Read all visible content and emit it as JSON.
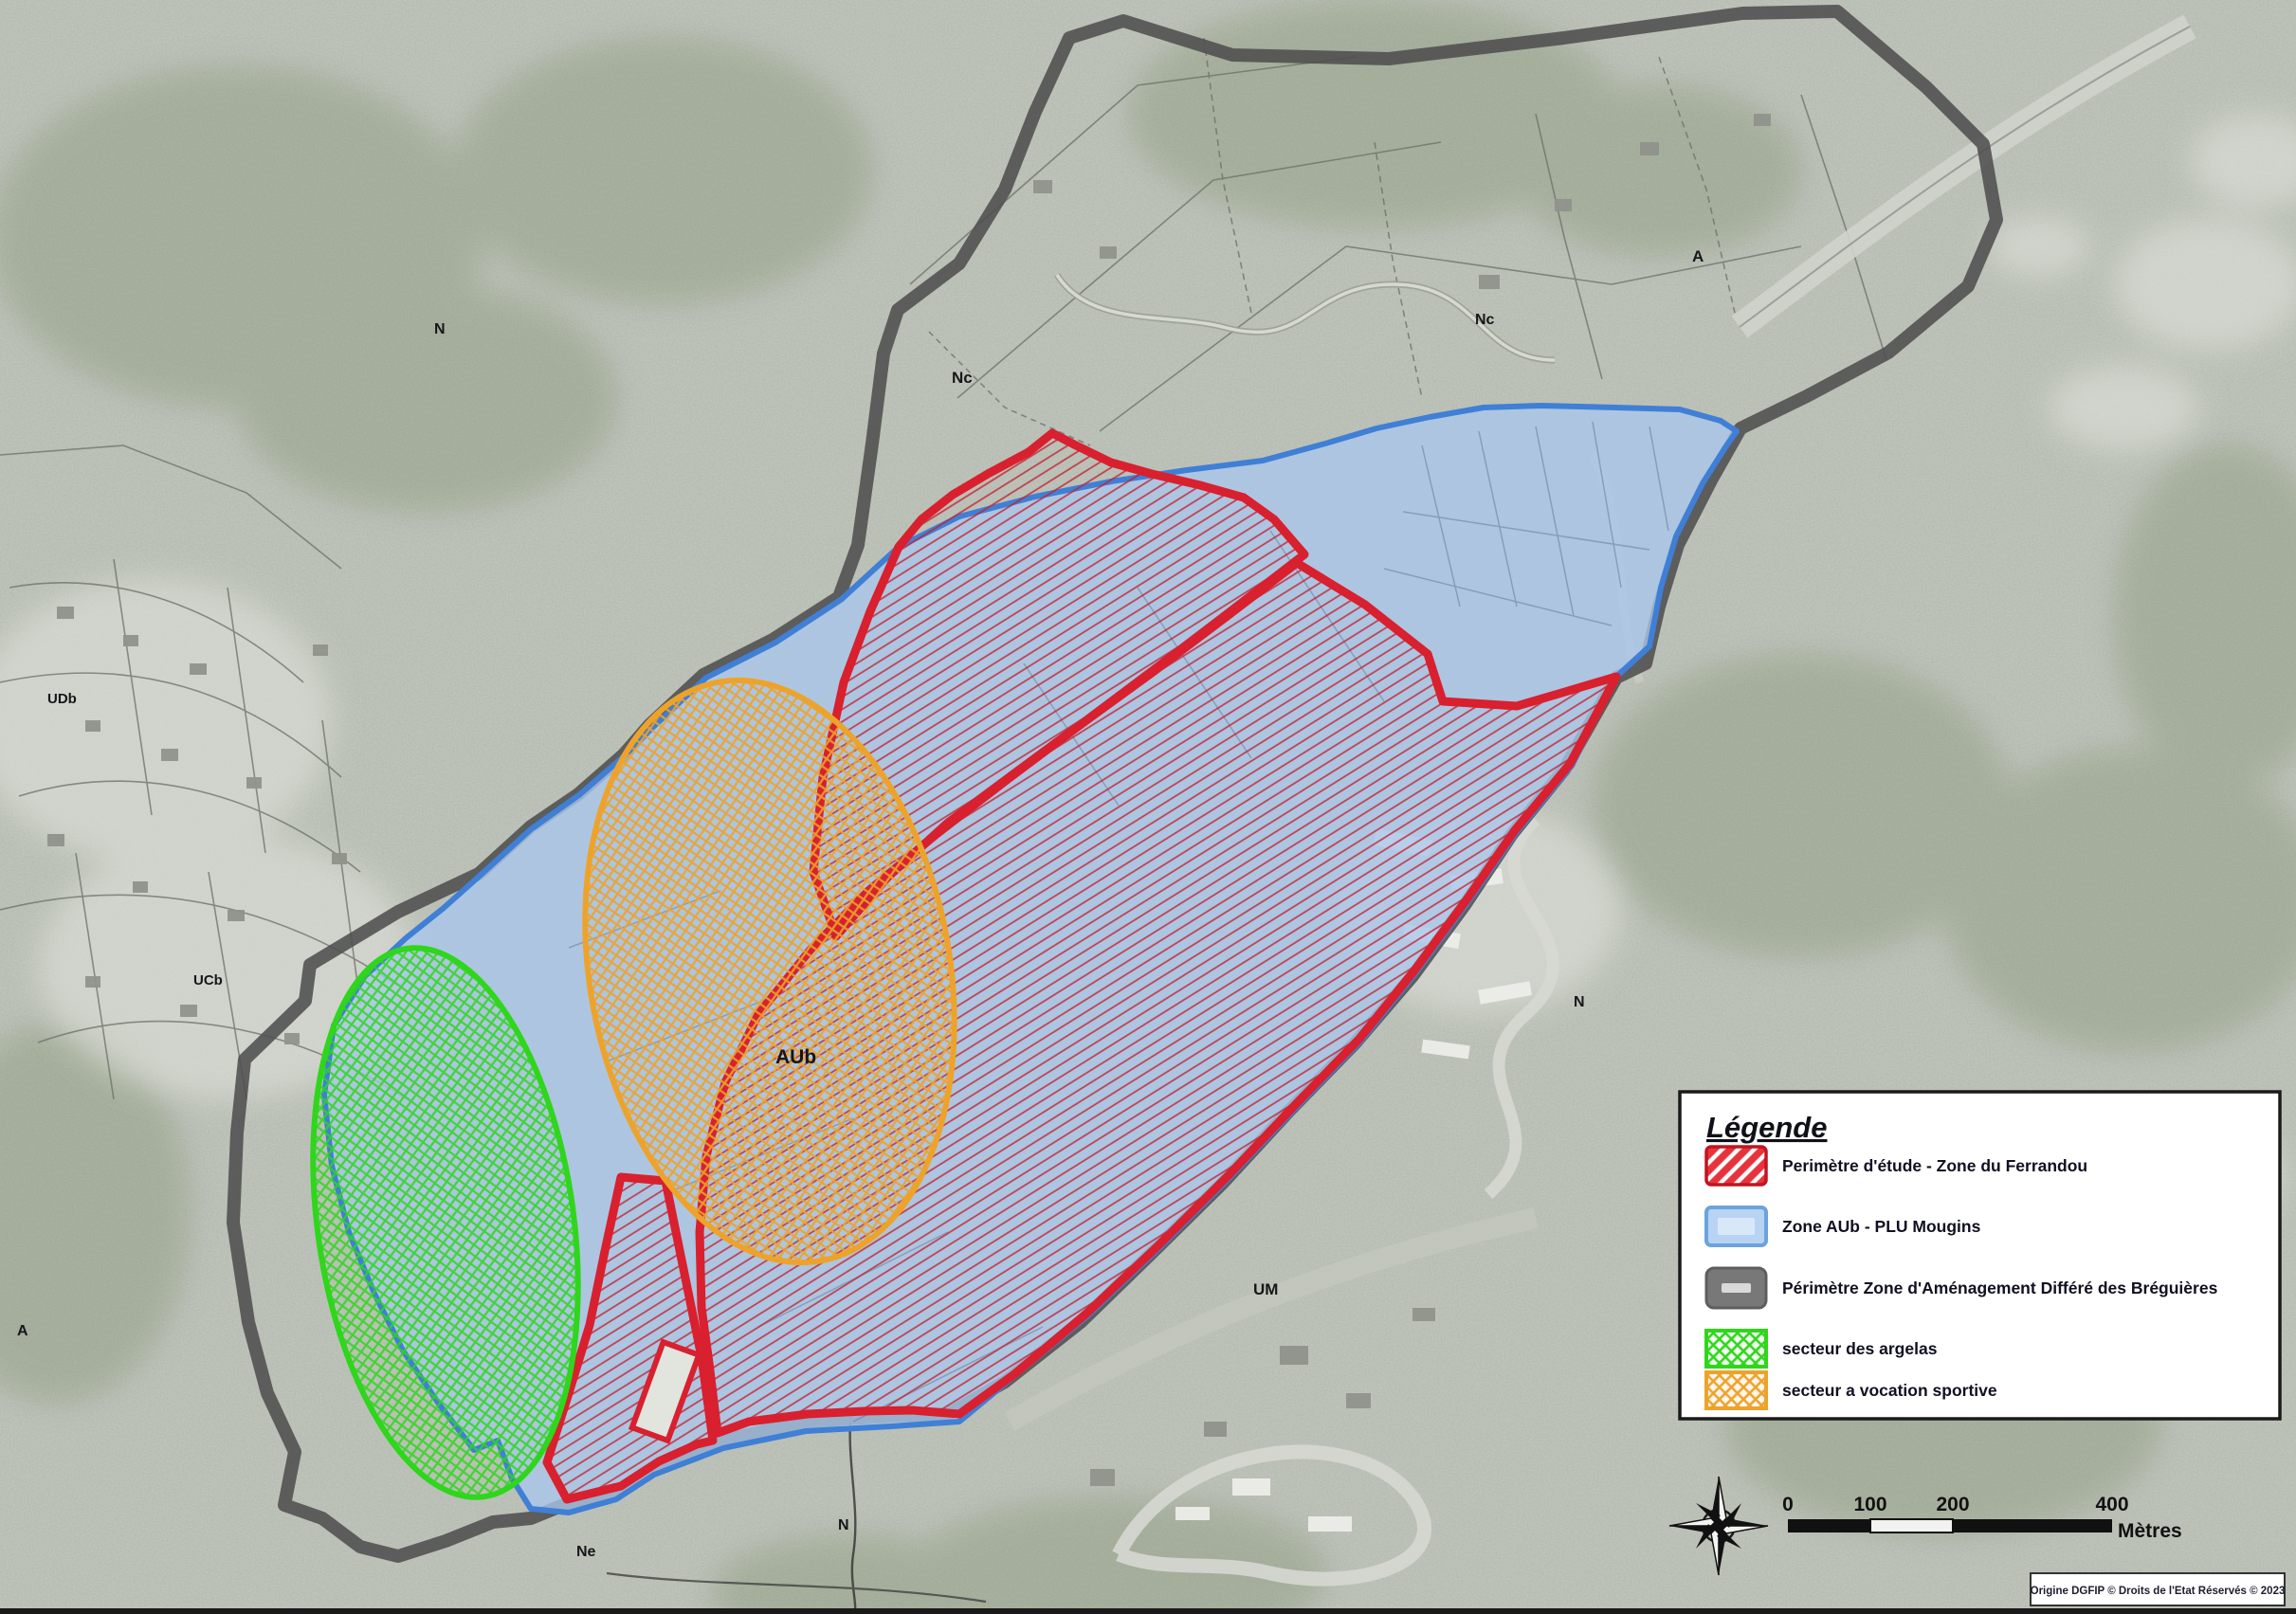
{
  "legend": {
    "title": "Légende",
    "items": [
      {
        "id": "perimetre-etude",
        "label": "Perimètre d'étude - Zone du Ferrandou",
        "swatch": "red-hatch",
        "color": "#d8202f"
      },
      {
        "id": "zone-aub",
        "label": "Zone AUb - PLU Mougins",
        "swatch": "blue-fill",
        "color": "#6ba3de"
      },
      {
        "id": "zad-breguieres",
        "label": "Périmètre Zone d'Aménagement Différé des Bréguières",
        "swatch": "gray-outline",
        "color": "#787878"
      },
      {
        "id": "secteur-argelas",
        "label": "secteur des argelas",
        "swatch": "green-crosshatch",
        "color": "#2fd61c"
      },
      {
        "id": "secteur-sportif",
        "label": "secteur a vocation sportive",
        "swatch": "orange-crosshatch",
        "color": "#eda32b"
      }
    ]
  },
  "map_labels": [
    {
      "id": "zone-n-northwest",
      "text": "N"
    },
    {
      "id": "zone-nc-center",
      "text": "Nc"
    },
    {
      "id": "zone-nc-east",
      "text": "Nc"
    },
    {
      "id": "zone-a-northeast",
      "text": "A"
    },
    {
      "id": "zone-udb-west",
      "text": "UDb"
    },
    {
      "id": "zone-ucb-west",
      "text": "UCb"
    },
    {
      "id": "zone-a-west",
      "text": "A"
    },
    {
      "id": "zone-aub-main",
      "text": "AUb"
    },
    {
      "id": "zone-um-south",
      "text": "UM"
    },
    {
      "id": "zone-n-east",
      "text": "N"
    },
    {
      "id": "zone-ne-south",
      "text": "Ne"
    },
    {
      "id": "zone-n-south",
      "text": "N"
    }
  ],
  "scale_bar": {
    "ticks": [
      "0",
      "100",
      "200",
      "400"
    ],
    "unit": "Mètres"
  },
  "attribution": "Origine DGFIP © Droits de l'Etat Réservés © 2023",
  "icons": {
    "compass": "compass-rose"
  },
  "colors": {
    "red_perimeter": "#d8202f",
    "blue_zone_fill": "#a9c6ec",
    "blue_zone_border": "#3f7fd6",
    "zad_gray": "#4f4f4f",
    "green_sector": "#2fd61c",
    "orange_sector": "#eda32b",
    "background": "#b6bcb2"
  }
}
